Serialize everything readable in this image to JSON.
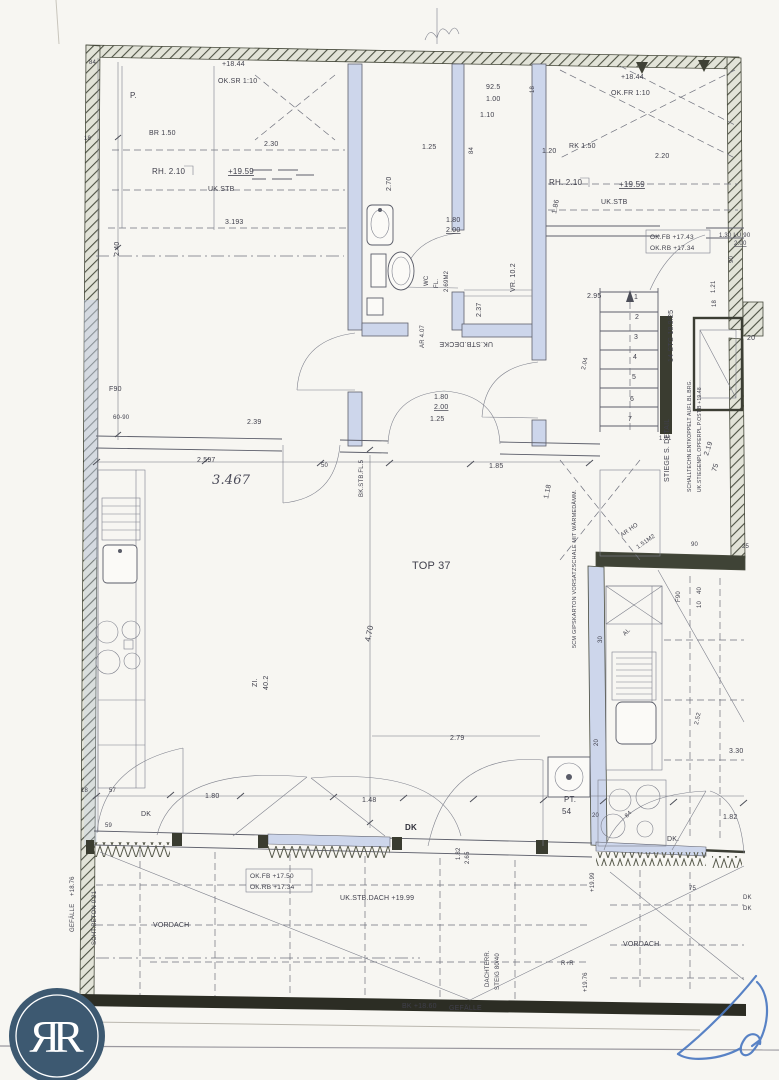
{
  "page": {
    "background": "#f7f6f2"
  },
  "logo": {
    "text": "ЯR",
    "circle_color": "#3d5971",
    "ring_color": "#ffffff"
  },
  "plan_title": "TOP 37",
  "colors": {
    "ink": "#3f3f4b",
    "wall_tint": "#cdd6eb",
    "hatch": "#4e5244",
    "bottom_wall": "#2c2d24",
    "signature_blue": "#4b79c2"
  },
  "labels": [
    {
      "t": "+18.44",
      "x": 222,
      "y": 66
    },
    {
      "t": "OK.SR 1:10",
      "x": 218,
      "y": 83
    },
    {
      "t": "84",
      "x": 89,
      "y": 64,
      "fs": 6
    },
    {
      "t": "P.",
      "x": 130,
      "y": 98,
      "fs": 8
    },
    {
      "t": "18",
      "x": 84,
      "y": 140,
      "fs": 6
    },
    {
      "t": "BR 1.50",
      "x": 149,
      "y": 135
    },
    {
      "t": "2.30",
      "x": 264,
      "y": 146
    },
    {
      "t": "RH. 2.10",
      "x": 152,
      "y": 174,
      "fs": 8
    },
    {
      "t": "+19.59",
      "x": 228,
      "y": 174,
      "fs": 8,
      "u": 1
    },
    {
      "t": "UK.STB",
      "x": 208,
      "y": 191
    },
    {
      "t": "3.193",
      "x": 225,
      "y": 224
    },
    {
      "t": "2.40",
      "x": 119,
      "y": 256,
      "r": -90
    },
    {
      "t": "92.5",
      "x": 486,
      "y": 89
    },
    {
      "t": "1.00",
      "x": 486,
      "y": 101
    },
    {
      "t": "1.10",
      "x": 480,
      "y": 117
    },
    {
      "t": "18",
      "x": 534,
      "y": 93,
      "fs": 6,
      "r": -90
    },
    {
      "t": "84",
      "x": 473,
      "y": 154,
      "fs": 6,
      "r": -90
    },
    {
      "t": "1.25",
      "x": 422,
      "y": 149
    },
    {
      "t": "1.20",
      "x": 542,
      "y": 153
    },
    {
      "t": "RK 1.50",
      "x": 569,
      "y": 148
    },
    {
      "t": "1.86",
      "x": 556,
      "y": 214,
      "r": -78
    },
    {
      "t": "1.80",
      "x": 446,
      "y": 222
    },
    {
      "t": "2.00",
      "x": 446,
      "y": 232,
      "u": 1
    },
    {
      "t": "2.70",
      "x": 391,
      "y": 191,
      "r": -90
    },
    {
      "t": "+18.44",
      "x": 621,
      "y": 79
    },
    {
      "t": "OK.FR 1:10",
      "x": 611,
      "y": 95
    },
    {
      "t": "2.20",
      "x": 655,
      "y": 158
    },
    {
      "t": "RH. 2.10",
      "x": 549,
      "y": 185,
      "fs": 8
    },
    {
      "t": "+19.59",
      "x": 619,
      "y": 187,
      "fs": 8,
      "u": 1
    },
    {
      "t": "UK.STB",
      "x": 601,
      "y": 204
    },
    {
      "t": "OK.FB +17.43",
      "x": 650,
      "y": 239,
      "fs": 6.5
    },
    {
      "t": "OK.RB +17.34",
      "x": 650,
      "y": 250,
      "fs": 6.5
    },
    {
      "t": "1.30 LU 90",
      "x": 719,
      "y": 237,
      "fs": 6
    },
    {
      "t": "2.00",
      "x": 734,
      "y": 245,
      "fs": 6,
      "u": 1
    },
    {
      "t": "90",
      "x": 733,
      "y": 263,
      "fs": 6,
      "r": -90
    },
    {
      "t": "1.21",
      "x": 715,
      "y": 293,
      "fs": 6,
      "r": -90
    },
    {
      "t": "18",
      "x": 716,
      "y": 307,
      "fs": 6,
      "r": -90
    },
    {
      "t": "20",
      "x": 747,
      "y": 340
    },
    {
      "t": "14 STG 18.9/25",
      "x": 673,
      "y": 362,
      "r": -90
    },
    {
      "t": "1",
      "x": 634,
      "y": 299
    },
    {
      "t": "2",
      "x": 635,
      "y": 319
    },
    {
      "t": "3",
      "x": 634,
      "y": 339
    },
    {
      "t": "4",
      "x": 633,
      "y": 359
    },
    {
      "t": "5",
      "x": 632,
      "y": 379
    },
    {
      "t": "6",
      "x": 630,
      "y": 401
    },
    {
      "t": "7",
      "x": 628,
      "y": 421
    },
    {
      "t": "2.95",
      "x": 587,
      "y": 298
    },
    {
      "t": "2.04",
      "x": 585,
      "y": 370,
      "fs": 6,
      "r": -78
    },
    {
      "t": "1.01",
      "x": 659,
      "y": 440,
      "fs": 6
    },
    {
      "t": "2.19",
      "x": 708,
      "y": 456,
      "r": -72
    },
    {
      "t": "75",
      "x": 716,
      "y": 472,
      "r": -72
    },
    {
      "t": "STIEGE S. DETAIL",
      "x": 669,
      "y": 482,
      "r": -90
    },
    {
      "t": "SCHALLTECHN.ENTKOPPELT AUFL.BL.BRG.",
      "x": 691,
      "y": 492,
      "fs": 5,
      "r": -90
    },
    {
      "t": "UK.STIEGENPL.OPFERPL.P.OST.B +19.48",
      "x": 701,
      "y": 492,
      "fs": 5,
      "r": -90
    },
    {
      "t": "AR HO",
      "x": 622,
      "y": 537,
      "fs": 6,
      "r": -35
    },
    {
      "t": "1.51M2",
      "x": 638,
      "y": 549,
      "fs": 6,
      "r": -35
    },
    {
      "t": "1.18",
      "x": 548,
      "y": 499,
      "r": -78
    },
    {
      "t": "WC",
      "x": 428,
      "y": 286,
      "fs": 6,
      "r": -90
    },
    {
      "t": "FL.",
      "x": 438,
      "y": 288,
      "fs": 6,
      "r": -90
    },
    {
      "t": "2.69M2",
      "x": 448,
      "y": 292,
      "fs": 6,
      "r": -90
    },
    {
      "t": "VR. 10.2",
      "x": 515,
      "y": 292,
      "r": -90
    },
    {
      "t": "2.37",
      "x": 481,
      "y": 317,
      "r": -90
    },
    {
      "t": "UK.STB.DECKE",
      "x": 493,
      "y": 342,
      "r": 180
    },
    {
      "t": "AR 4.07",
      "x": 424,
      "y": 348,
      "fs": 6,
      "r": -90
    },
    {
      "t": "1.80",
      "x": 434,
      "y": 399
    },
    {
      "t": "2.00",
      "x": 434,
      "y": 409,
      "u": 1
    },
    {
      "t": "1.25",
      "x": 430,
      "y": 421
    },
    {
      "t": "TOP 37",
      "x": 412,
      "y": 569,
      "fs": 11
    },
    {
      "t": "4.70",
      "x": 370,
      "y": 642,
      "fs": 8,
      "r": -78
    },
    {
      "t": "2.79",
      "x": 450,
      "y": 740
    },
    {
      "t": "ZI.",
      "x": 257,
      "y": 687,
      "r": -90
    },
    {
      "t": "40.2",
      "x": 268,
      "y": 690,
      "r": -90
    },
    {
      "t": "BK.STB.FL.5",
      "x": 363,
      "y": 497,
      "fs": 6,
      "r": -90
    },
    {
      "t": "5CM GIPSKARTON VORSATZSCHALE MIT WÄRMEDÄMM.",
      "x": 576,
      "y": 648,
      "fs": 5.5,
      "r": -90
    },
    {
      "t": "F90",
      "x": 109,
      "y": 391
    },
    {
      "t": "60-90",
      "x": 113,
      "y": 419,
      "fs": 6
    },
    {
      "t": "2.39",
      "x": 247,
      "y": 424
    },
    {
      "t": "2.597",
      "x": 197,
      "y": 462
    },
    {
      "t": "3.467",
      "x": 212,
      "y": 484,
      "fs": 13,
      "h": 1
    },
    {
      "t": "50",
      "x": 321,
      "y": 467,
      "fs": 6
    },
    {
      "t": "1.85",
      "x": 489,
      "y": 468
    },
    {
      "t": "18",
      "x": 81,
      "y": 792,
      "fs": 6
    },
    {
      "t": "57",
      "x": 109,
      "y": 792,
      "fs": 6
    },
    {
      "t": "59",
      "x": 105,
      "y": 827,
      "fs": 6
    },
    {
      "t": "DK",
      "x": 141,
      "y": 816
    },
    {
      "t": "1.80",
      "x": 205,
      "y": 798
    },
    {
      "t": "1.48",
      "x": 362,
      "y": 802
    },
    {
      "t": "DK",
      "x": 405,
      "y": 830,
      "fs": 8,
      "b": 1
    },
    {
      "t": "1.82",
      "x": 460,
      "y": 860,
      "fs": 6,
      "r": -90
    },
    {
      "t": "2.65",
      "x": 469,
      "y": 864,
      "fs": 6,
      "r": -90
    },
    {
      "t": "OK.FB +17.50",
      "x": 250,
      "y": 878,
      "fs": 6.5
    },
    {
      "t": "OK.RB +17.34",
      "x": 250,
      "y": 889,
      "fs": 6.5
    },
    {
      "t": "UK.STB.DACH +19.99",
      "x": 340,
      "y": 900
    },
    {
      "t": "VORDACH",
      "x": 153,
      "y": 927
    },
    {
      "t": "VORDACH",
      "x": 623,
      "y": 946
    },
    {
      "t": "GEFÄLLE",
      "x": 74,
      "y": 932,
      "fs": 6,
      "r": -90
    },
    {
      "t": "+18.76",
      "x": 74,
      "y": 896,
      "fs": 6,
      "r": -90
    },
    {
      "t": "SCHT.BETON 0.21",
      "x": 96,
      "y": 945,
      "fs": 6,
      "r": -90
    },
    {
      "t": "BK +18.60",
      "x": 402,
      "y": 1008
    },
    {
      "t": "GEFÄLLE",
      "x": 449,
      "y": 1010
    },
    {
      "t": "DACHTERR.",
      "x": 489,
      "y": 987,
      "fs": 6,
      "r": -90
    },
    {
      "t": "STEIG 80/40",
      "x": 499,
      "y": 990,
      "fs": 6,
      "r": -90
    },
    {
      "t": "R+R",
      "x": 561,
      "y": 965,
      "fs": 6
    },
    {
      "t": "+19.76",
      "x": 587,
      "y": 992,
      "fs": 6,
      "r": -90
    },
    {
      "t": "+19.99",
      "x": 594,
      "y": 892,
      "fs": 6,
      "r": -90
    },
    {
      "t": "PT.",
      "x": 564,
      "y": 802,
      "fs": 8
    },
    {
      "t": "54",
      "x": 562,
      "y": 814,
      "fs": 8
    },
    {
      "t": "20",
      "x": 592,
      "y": 817,
      "fs": 6
    },
    {
      "t": "84",
      "x": 627,
      "y": 818,
      "fs": 6,
      "r": -45
    },
    {
      "t": "DK.",
      "x": 667,
      "y": 841
    },
    {
      "t": "1.82",
      "x": 723,
      "y": 819
    },
    {
      "t": "75",
      "x": 689,
      "y": 890,
      "fs": 6
    },
    {
      "t": "DK",
      "x": 743,
      "y": 899,
      "fs": 6
    },
    {
      "t": "DK",
      "x": 743,
      "y": 910,
      "fs": 6
    },
    {
      "t": "3.30",
      "x": 729,
      "y": 753
    },
    {
      "t": "2.52",
      "x": 698,
      "y": 725,
      "fs": 6,
      "r": -78
    },
    {
      "t": "40",
      "x": 701,
      "y": 594,
      "fs": 6,
      "r": -90
    },
    {
      "t": "10",
      "x": 701,
      "y": 608,
      "fs": 6,
      "r": -90
    },
    {
      "t": "F90",
      "x": 680,
      "y": 602,
      "fs": 6,
      "r": -90
    },
    {
      "t": "AL",
      "x": 625,
      "y": 636,
      "fs": 6,
      "r": -45
    },
    {
      "t": "30",
      "x": 602,
      "y": 643,
      "fs": 6,
      "r": -90
    },
    {
      "t": "20",
      "x": 598,
      "y": 746,
      "fs": 6,
      "r": -90
    },
    {
      "t": "90",
      "x": 691,
      "y": 546,
      "fs": 6
    },
    {
      "t": "25",
      "x": 742,
      "y": 548,
      "fs": 6
    }
  ]
}
